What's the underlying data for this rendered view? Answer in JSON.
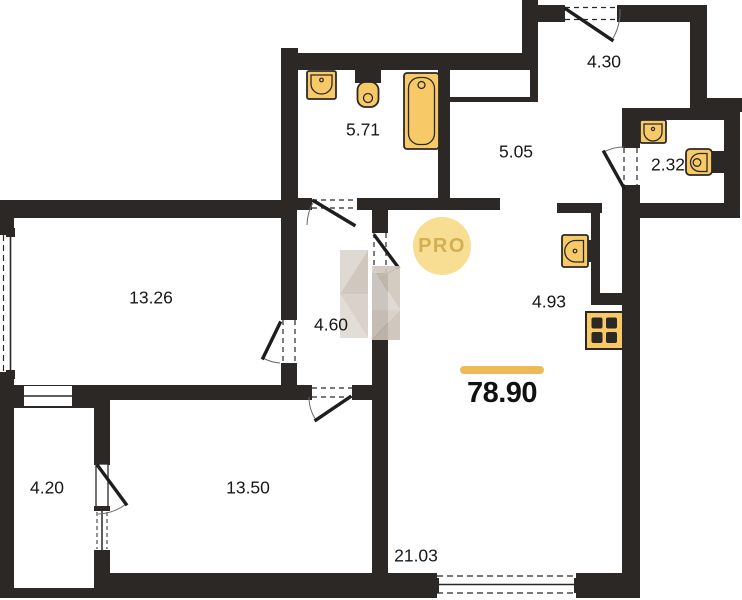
{
  "plan": {
    "title": "apartment-floor-plan",
    "total_area": "78.90",
    "watermark_badge": "PRO",
    "rooms": [
      {
        "name": "entry-hall",
        "area": "4.30"
      },
      {
        "name": "bathroom",
        "area": "5.71"
      },
      {
        "name": "corridor",
        "area": "5.05"
      },
      {
        "name": "wc",
        "area": "2.32"
      },
      {
        "name": "room-1",
        "area": "13.26"
      },
      {
        "name": "hallway",
        "area": "4.60"
      },
      {
        "name": "kitchen-zone",
        "area": "4.93"
      },
      {
        "name": "balcony",
        "area": "4.20"
      },
      {
        "name": "room-2",
        "area": "13.50"
      },
      {
        "name": "living-zone",
        "area": "21.03"
      }
    ],
    "fixtures": [
      "sink",
      "toilet",
      "bathtub",
      "wc-sink",
      "wc-toilet",
      "kitchen-sink",
      "stove"
    ],
    "colors": {
      "wall": "#2B2826",
      "fixture_fill": "#F7CA67",
      "accent_bar": "#EDBA58",
      "badge_bg": "#F8DE92",
      "badge_text": "#D4AE52",
      "watermark_gray": "#DBD5CE",
      "watermark_tan": "#CCC2B7"
    }
  }
}
